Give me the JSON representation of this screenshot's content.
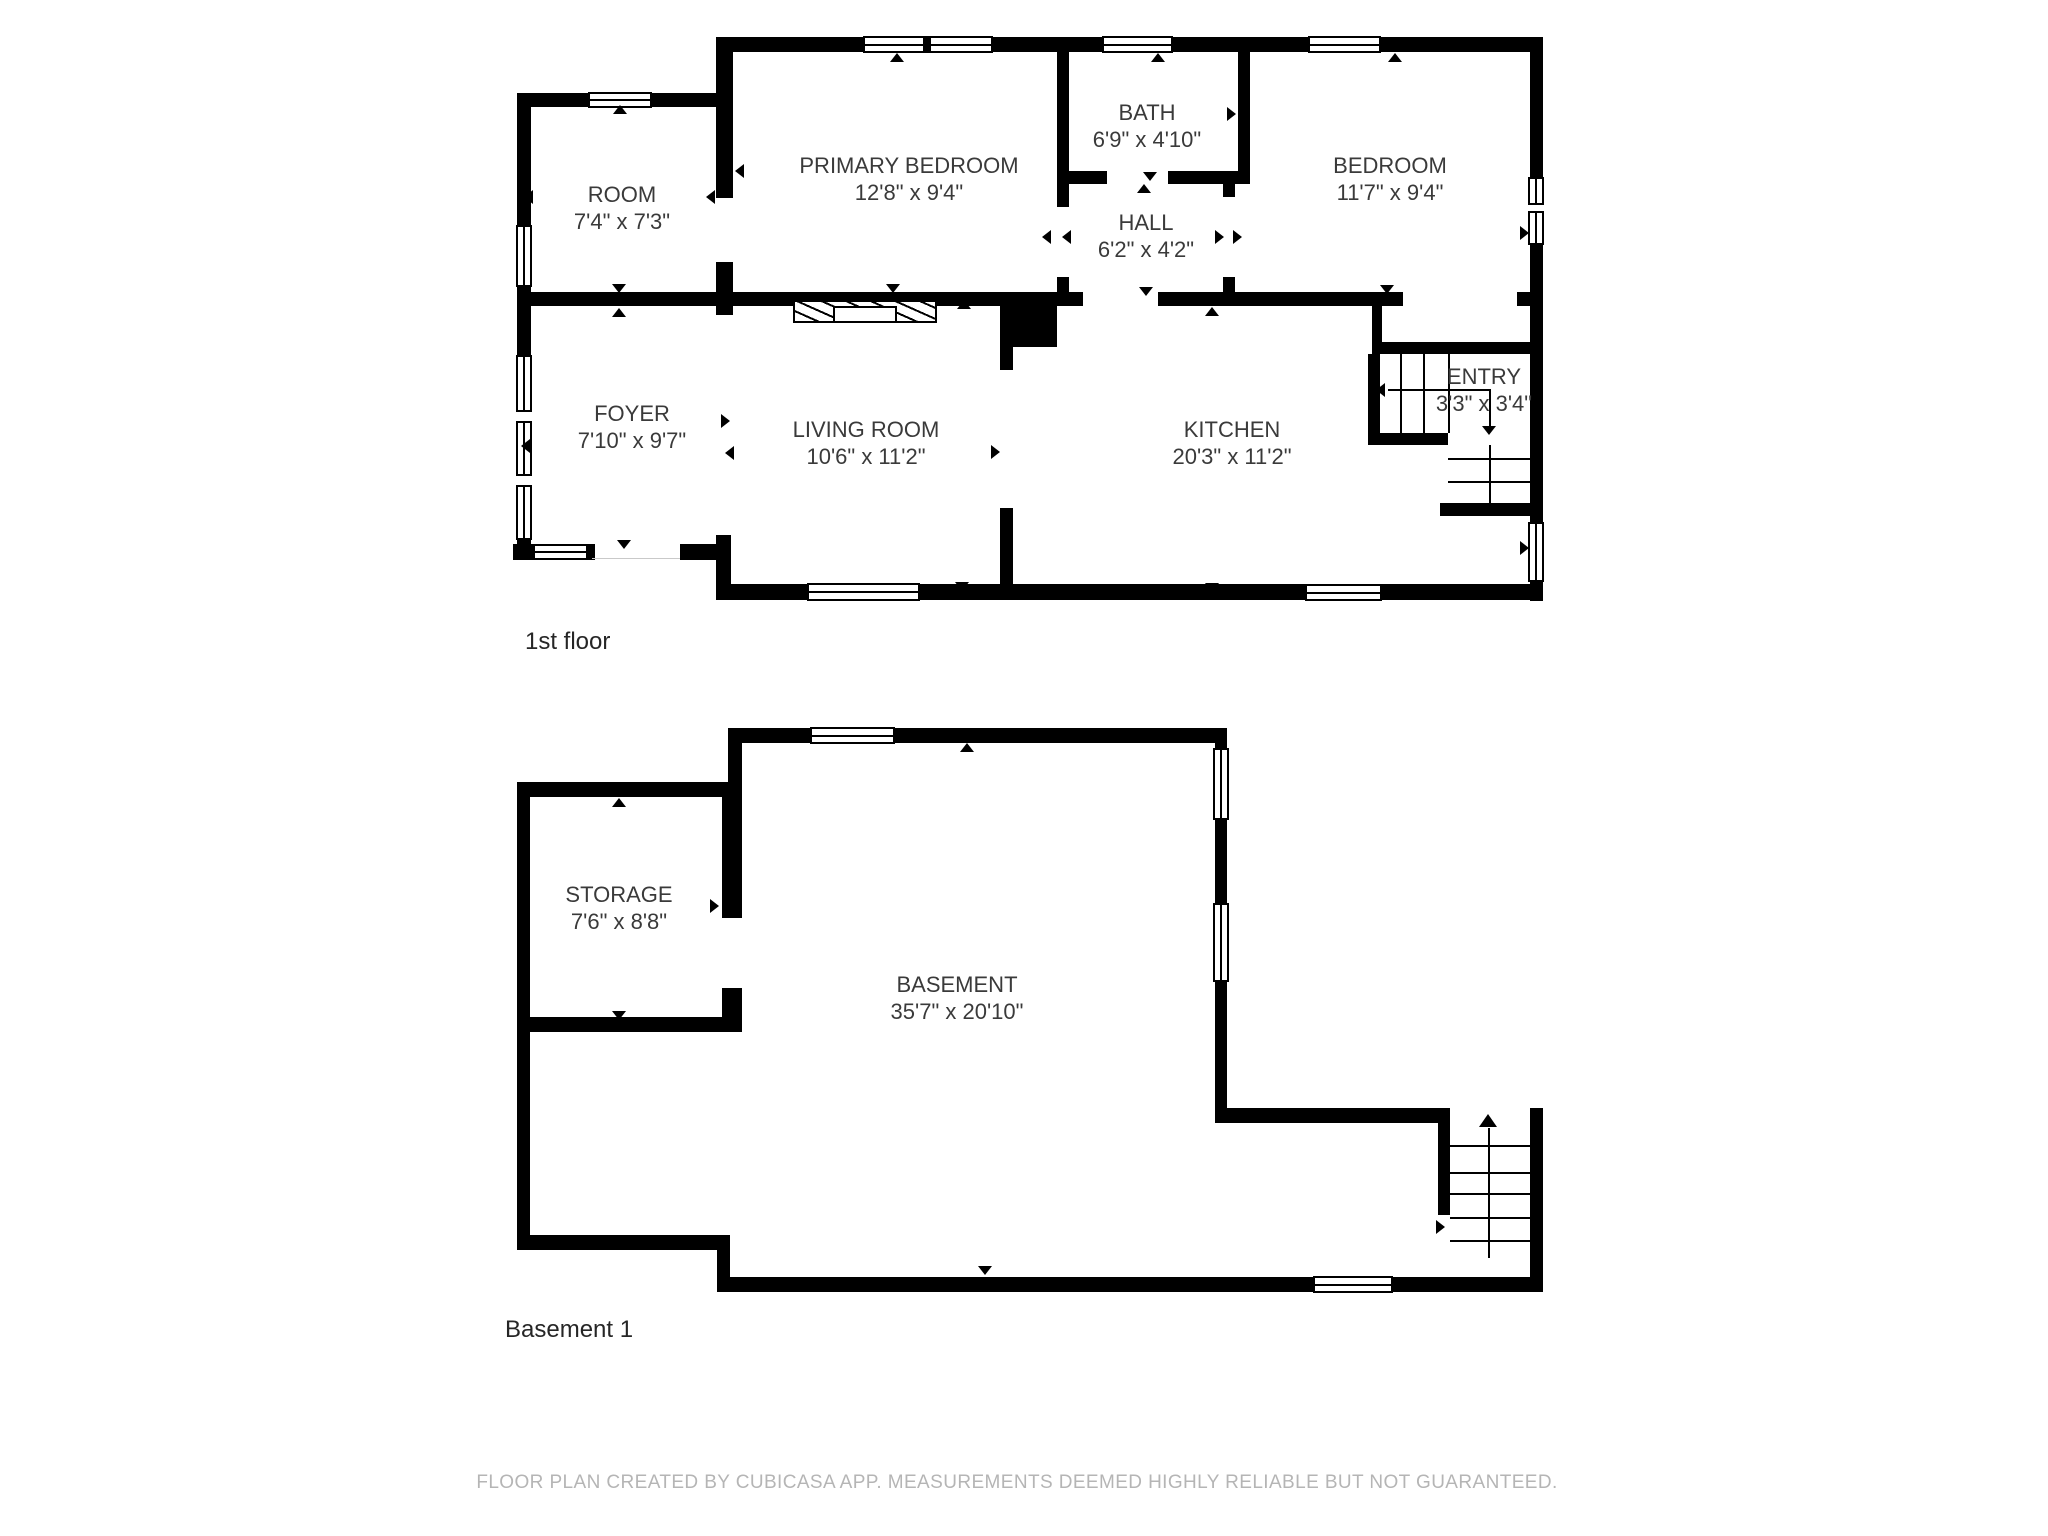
{
  "floors": [
    {
      "title": "1st floor",
      "rooms": [
        {
          "name": "ROOM",
          "dims": "7'4\" x 7'3\""
        },
        {
          "name": "PRIMARY BEDROOM",
          "dims": "12'8\" x 9'4\""
        },
        {
          "name": "BATH",
          "dims": "6'9\" x 4'10\""
        },
        {
          "name": "HALL",
          "dims": "6'2\" x 4'2\""
        },
        {
          "name": "BEDROOM",
          "dims": "11'7\" x 9'4\""
        },
        {
          "name": "FOYER",
          "dims": "7'10\" x 9'7\""
        },
        {
          "name": "LIVING ROOM",
          "dims": "10'6\" x 11'2\""
        },
        {
          "name": "KITCHEN",
          "dims": "20'3\" x 11'2\""
        },
        {
          "name": "ENTRY",
          "dims": "3'3\" x 3'4\""
        }
      ]
    },
    {
      "title": "Basement 1",
      "rooms": [
        {
          "name": "STORAGE",
          "dims": "7'6\" x 8'8\""
        },
        {
          "name": "BASEMENT",
          "dims": "35'7\" x 20'10\""
        }
      ]
    }
  ],
  "footer": "FLOOR PLAN CREATED BY CUBICASA APP. MEASUREMENTS DEEMED HIGHLY RELIABLE BUT NOT GUARANTEED.",
  "colors": {
    "wall": "#000000",
    "room_label": "#3a3a3a",
    "floor_title": "#262626",
    "footer_text": "#b5b5b5",
    "background": "#ffffff"
  }
}
